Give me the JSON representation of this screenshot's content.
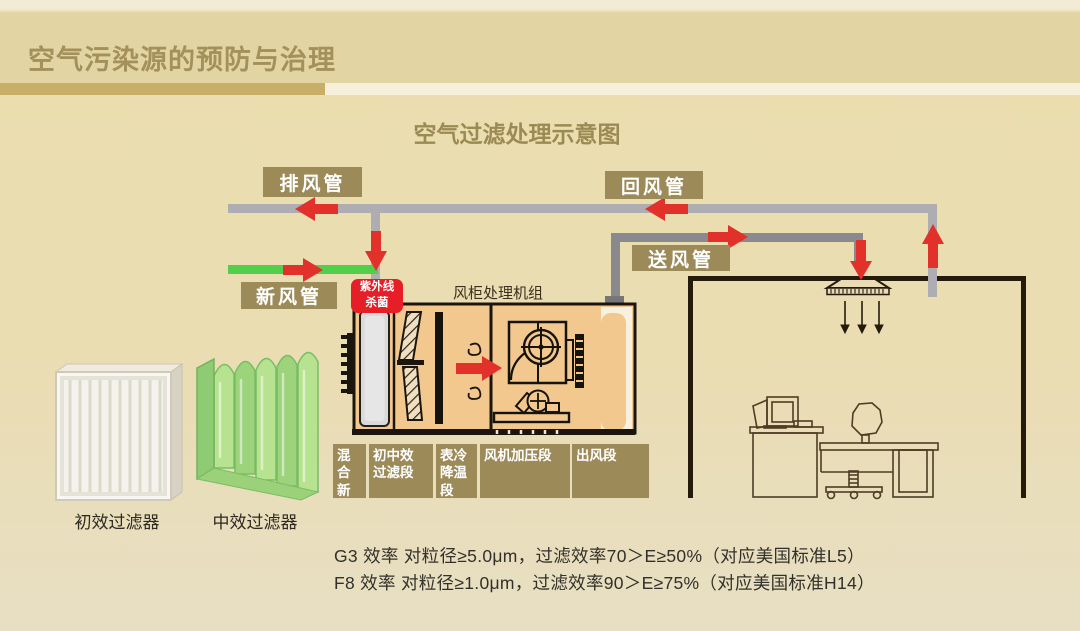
{
  "header": {
    "title": "空气污染源的预防与治理"
  },
  "diagram": {
    "title": "空气过滤处理示意图",
    "labels": {
      "exhaust_duct": "排风管",
      "return_duct": "回风管",
      "fresh_air_duct": "新风管",
      "supply_duct": "送风管"
    },
    "uv_badge": "紫外线\n杀菌",
    "ahu_title": "风柜处理机组",
    "ahu_sections": [
      "混合\n新风\n段",
      "初中效\n过滤段",
      "表冷\n降温\n段",
      "风机加压段",
      "出风段"
    ],
    "filter_captions": [
      "初效过滤器",
      "中效过滤器"
    ]
  },
  "notes": [
    "G3 效率 对粒径≥5.0μm，过滤效率70＞E≥50%（对应美国标准L5）",
    "F8 效率 对粒径≥1.0μm，过滤效率90＞E≥75%（对应美国标准H14）"
  ],
  "colors": {
    "accent_red": "#e2302b",
    "label_olive": "#9c8a58",
    "duct_gray": "#aeaeb2",
    "supply_duct_gray": "#8a8a8e",
    "fresh_air_green": "#52cf4a",
    "ahu_fill": "#f2c88e",
    "title_gold": "#a3905a"
  }
}
